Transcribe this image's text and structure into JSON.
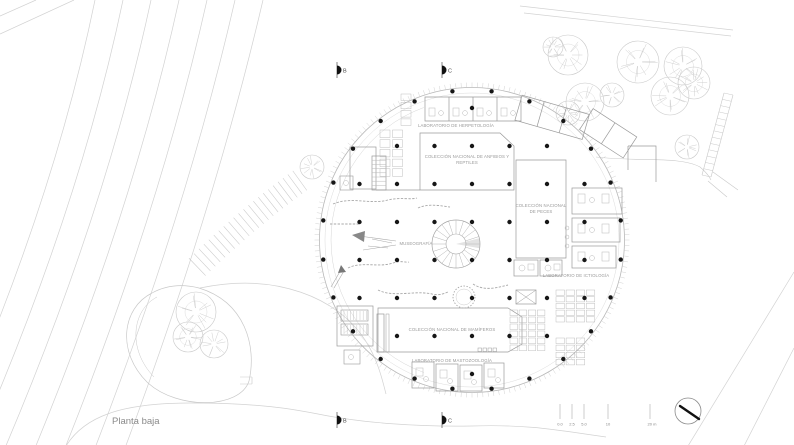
{
  "title": "Planta baja",
  "sections": {
    "b": "B",
    "c": "C"
  },
  "plan_labels": {
    "herpetologia": "LABORATORIO DE HERPETOLOGÍA",
    "anfibios_l1": "COLECCIÓN NACIONAL DE ANFIBIOS Y",
    "anfibios_l2": "REPTILES",
    "peces_l1": "COLECCIÓN NACIONAL",
    "peces_l2": "DE PECES",
    "museografia": "MUSEOGRAFÍA",
    "ictiologia": "LABORATORIO DE ICTIOLOGÍA",
    "mamiferos": "COLECCIÓN NACIONAL DE MAMÍFEROS",
    "mastozoologia": "LABORATORIO DE MASTOZOOLOGÍA"
  },
  "scale_bar": {
    "ticks": [
      "0.0",
      "2.5",
      "5.0",
      "10",
      "20 m"
    ]
  },
  "colors": {
    "background": "#ffffff",
    "road": "#d2d2d2",
    "landscape": "#c9c9c9",
    "rim": "#b8b8b8",
    "rim_tick": "#cdcdcd",
    "wall": "#9a9a9a",
    "furniture": "#b8b8b8",
    "partition": "#a8a8a8",
    "column": "#161616",
    "text": "#999999",
    "title_text": "#8a8a8a",
    "marker": "#111111"
  }
}
